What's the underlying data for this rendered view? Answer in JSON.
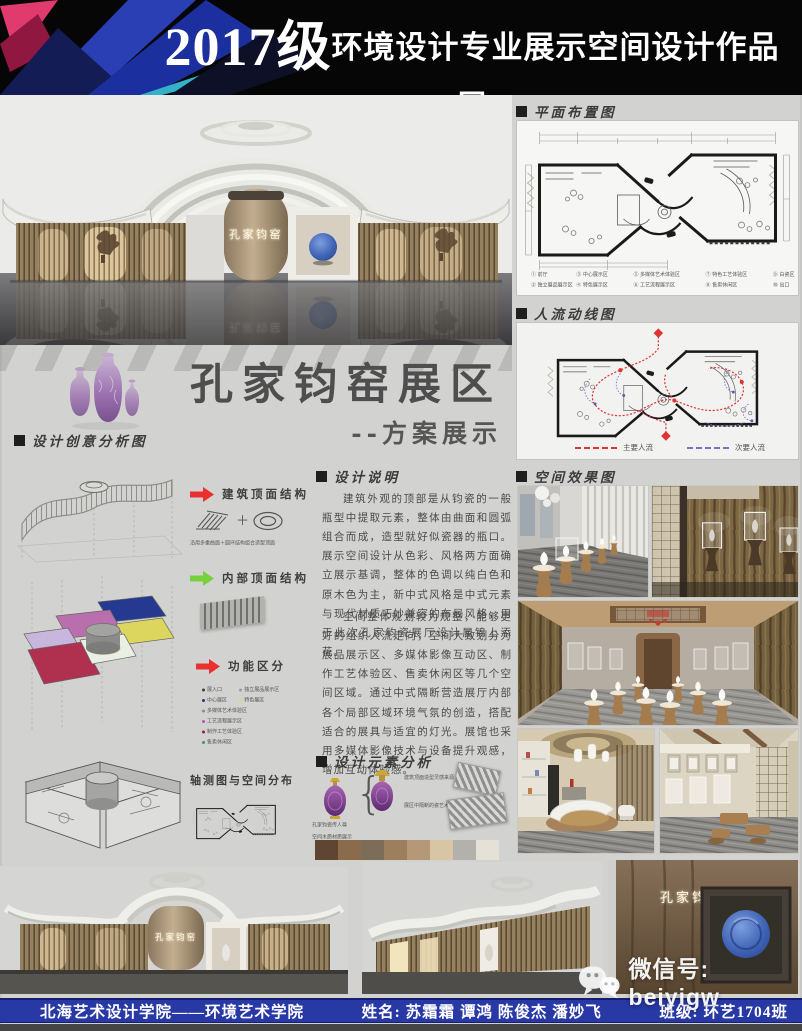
{
  "header": {
    "year": "2017级",
    "title_cn": "环境设计专业展示空间设计作品展",
    "subtitle_en": "2017 environmental design professional exhibition space design works exhibition"
  },
  "hero": {
    "sign_text": "孔家钧窑"
  },
  "title_block": {
    "main": "孔家钧窑展区",
    "sub": "--方案展示"
  },
  "right_col": {
    "floor_plan": {
      "label": "平面布置图",
      "legend_rows": [
        [
          "① 前厅",
          "③ 中心展示区",
          "⑤ 多媒体艺术体验区",
          "⑦ 特色工艺体验区",
          "⑨ 白瓷区"
        ],
        [
          "② 独立展品展示区",
          "④ 特色展示区",
          "⑥ 工艺流程展示区",
          "⑧ 售卖休闲区",
          "⑩ 出口"
        ]
      ]
    },
    "flow": {
      "label": "人流动线图",
      "legend_main": "主要人流",
      "legend_secondary": "次要人流"
    },
    "renders": {
      "label": "空间效果图"
    }
  },
  "concept": {
    "label": "设计创意分析图",
    "roof_structure": "建筑顶面结构",
    "roof_caption": "沿用多重曲面＋圆环结构组合造型顶面",
    "interior_structure": "内部顶面结构",
    "function_label": "功能区分",
    "axon_label": "轴测图与空间分布",
    "legend": [
      {
        "color": "#3f3f3f",
        "label": "展入口"
      },
      {
        "color": "#9a9a9a",
        "label": "独立展品展示区"
      },
      {
        "color": "#27357f",
        "label": "中心展区"
      },
      {
        "color": "#ded867",
        "label": "特色展区"
      },
      {
        "color": "#8c8c8c",
        "label": "多媒体艺术体验区"
      },
      {
        "color": "#bf4ec1",
        "label": "工艺流程展示区"
      },
      {
        "color": "#8e1f3e",
        "label": "制作工艺体验区"
      },
      {
        "color": "#3a9e5a",
        "label": "售卖休闲区"
      }
    ]
  },
  "description": {
    "label": "设计说明",
    "p1": "建筑外观的顶部是从钧瓷的一般瓶型中提取元素，整体由曲面和圆弧组合而成，造型就好似瓷器的瓶口。展示空间设计从色彩、风格两方面确立展示基调，整体的色调以纯白色和原木色为主，新中式风格是中式元素与现代材质巧妙兼容的布局风格，用于此次孔家钧瓷展厅设计属锦上添花。",
    "p2": "空间整体规划较为规整，能够更好的组织人流走向，空间大致划分为展品展示区、多媒体影像互动区、制作工艺体验区、售卖休闲区等几个空间区域。通过中式隔断营造展厅内部各个局部区域环境气氛的创造，搭配适合的展具与适宜的灯光。展馆也采用多媒体影像技术与设备提升观感，增加互动体验感。"
  },
  "elements": {
    "label": "设计元素分析",
    "vase_caption": "孔家钧瓷传人尊",
    "material_caption": "空间木质材质展示",
    "note_roof": "建筑顶面造型灵感来源",
    "note_screen": "展区中隔断的瓷艺术装饰区",
    "swatches": [
      "#5f4632",
      "#8a6b4c",
      "#7c6d58",
      "#9c7f5d",
      "#b59878",
      "#d8c5a4",
      "#b3b1ac",
      "#e6e1d7"
    ]
  },
  "footer": {
    "school": "北海艺术设计学院——环境艺术学院",
    "name_label": "姓名:",
    "names": "苏霜霜 谭鸿 陈俊杰 潘妙飞",
    "class_label": "班级:",
    "class_value": "环艺1704班"
  },
  "watermark": {
    "text": "微信号: beiyigw"
  },
  "colors": {
    "bar_blue": "#2839a6",
    "flow_main": "#dd3434",
    "flow_secondary": "#7272cc",
    "arrow_red": "#e8312f",
    "arrow_green": "#77d13f"
  }
}
